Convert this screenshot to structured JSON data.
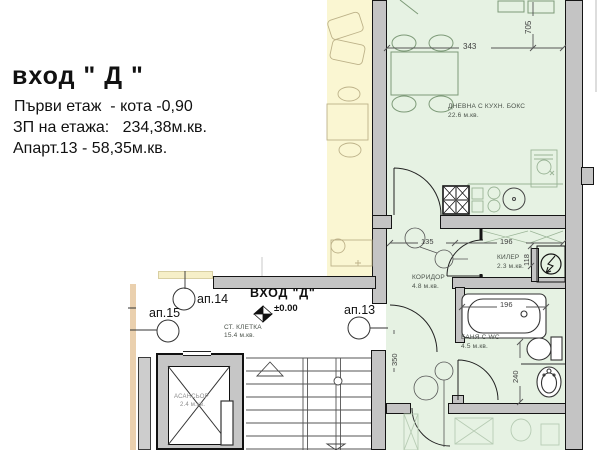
{
  "title_block": {
    "title": "вход \" Д \"",
    "floor_line": "Първи етаж  - кота -0,90",
    "area_line": "ЗП на етажа:   234,38м.кв.",
    "apartment_line": "Апарт.13 - 58,35м.кв."
  },
  "entrance": {
    "label": "ВХОД \"Д\"",
    "level": "±0.00",
    "stair_room": "СТ. КЛЕТКА",
    "stair_area": "15.4 м.кв."
  },
  "apartments": {
    "ap13": "ап.13",
    "ap14": "ап.14",
    "ap15": "ап.15"
  },
  "rooms": {
    "living": {
      "name": "ДНЕВНА С КУХН. БОКС",
      "area": "22.6 м.кв."
    },
    "corridor": {
      "name": "КОРИДОР",
      "area": "4.8 м.кв."
    },
    "closet": {
      "name": "КИЛЕР",
      "area": "2.3 м.кв."
    },
    "bath": {
      "name": "БАНЯ С WC",
      "area": "4.5 м.кв."
    },
    "elevator": {
      "name": "АСАНСЬОР",
      "area": "2.4 м.кв."
    }
  },
  "dimensions": {
    "living_width": "343",
    "living_depth": "705",
    "corridor_width": "135",
    "closet_width": "196",
    "closet_depth": "118",
    "bath_width": "196",
    "bath_depth": "240",
    "entry_depth": "350"
  },
  "colors": {
    "room_yellow": "#FAF6D2",
    "room_green": "#E6F2E3",
    "wall_fill": "#C4C4C4",
    "wall_line": "#151515",
    "tan_strip": "#EAD0AE",
    "faint_furniture_green": "#9AB496",
    "faint_furniture_yellow": "#BDB289",
    "dim_line": "#555555"
  }
}
